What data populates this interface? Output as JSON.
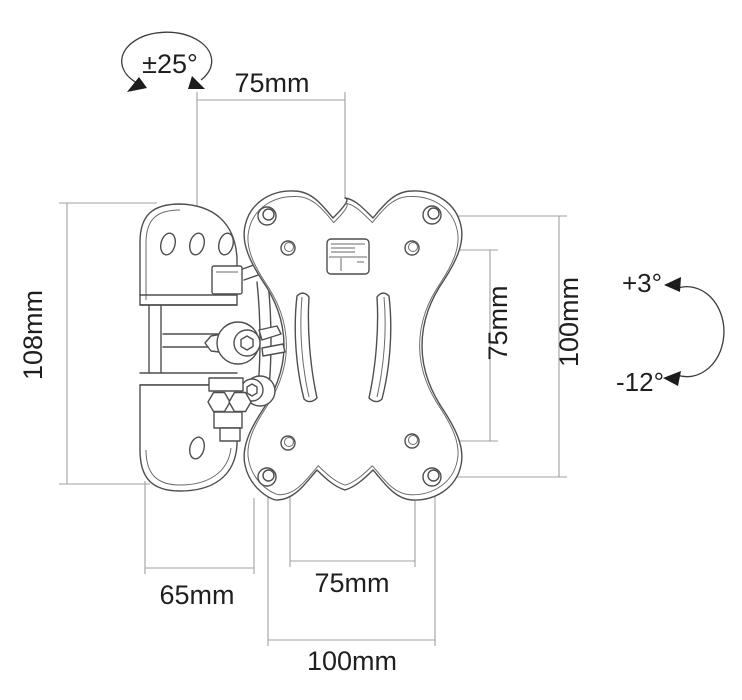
{
  "diagram": {
    "type": "technical-dimension-drawing",
    "subject": "tilt-and-swivel TV wall mount bracket with VESA plate",
    "colors": {
      "background": "#ffffff",
      "drawing_line": "#4f4f4f",
      "dimension_line": "#a0a0a0",
      "text": "#1f1f1f"
    },
    "labels": {
      "swivel_range": "±25°",
      "top_width": "75mm",
      "bracket_height": "108mm",
      "vesa_vertical_inner": "75mm",
      "vesa_vertical_outer": "100mm",
      "tilt_up": "+3°",
      "tilt_down": "-12°",
      "bottom_offset": "65mm",
      "vesa_horizontal_inner": "75mm",
      "vesa_horizontal_outer": "100mm"
    }
  }
}
